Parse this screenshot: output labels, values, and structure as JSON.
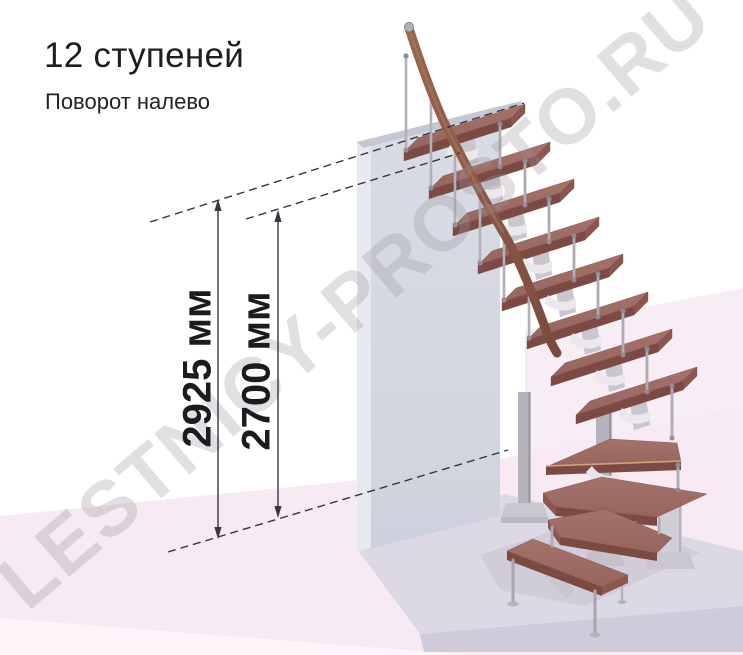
{
  "header": {
    "title": "12 ступеней",
    "subtitle": "Поворот налево"
  },
  "dimensions": {
    "overall_height": "2925 мм",
    "inner_height": "2700 мм"
  },
  "watermark": "LESTNICY-PROSTO.RU",
  "colors": {
    "tread_wood": "#9c6a62",
    "tread_front": "#7c4a43",
    "handrail_wood": "#8a5a49",
    "metal": "#b5b2ba",
    "wall": "#d5d8e2",
    "floor_pink": "#f8eaf3",
    "platform": "#dcd8e4",
    "dimension_line": "#3a3444"
  }
}
